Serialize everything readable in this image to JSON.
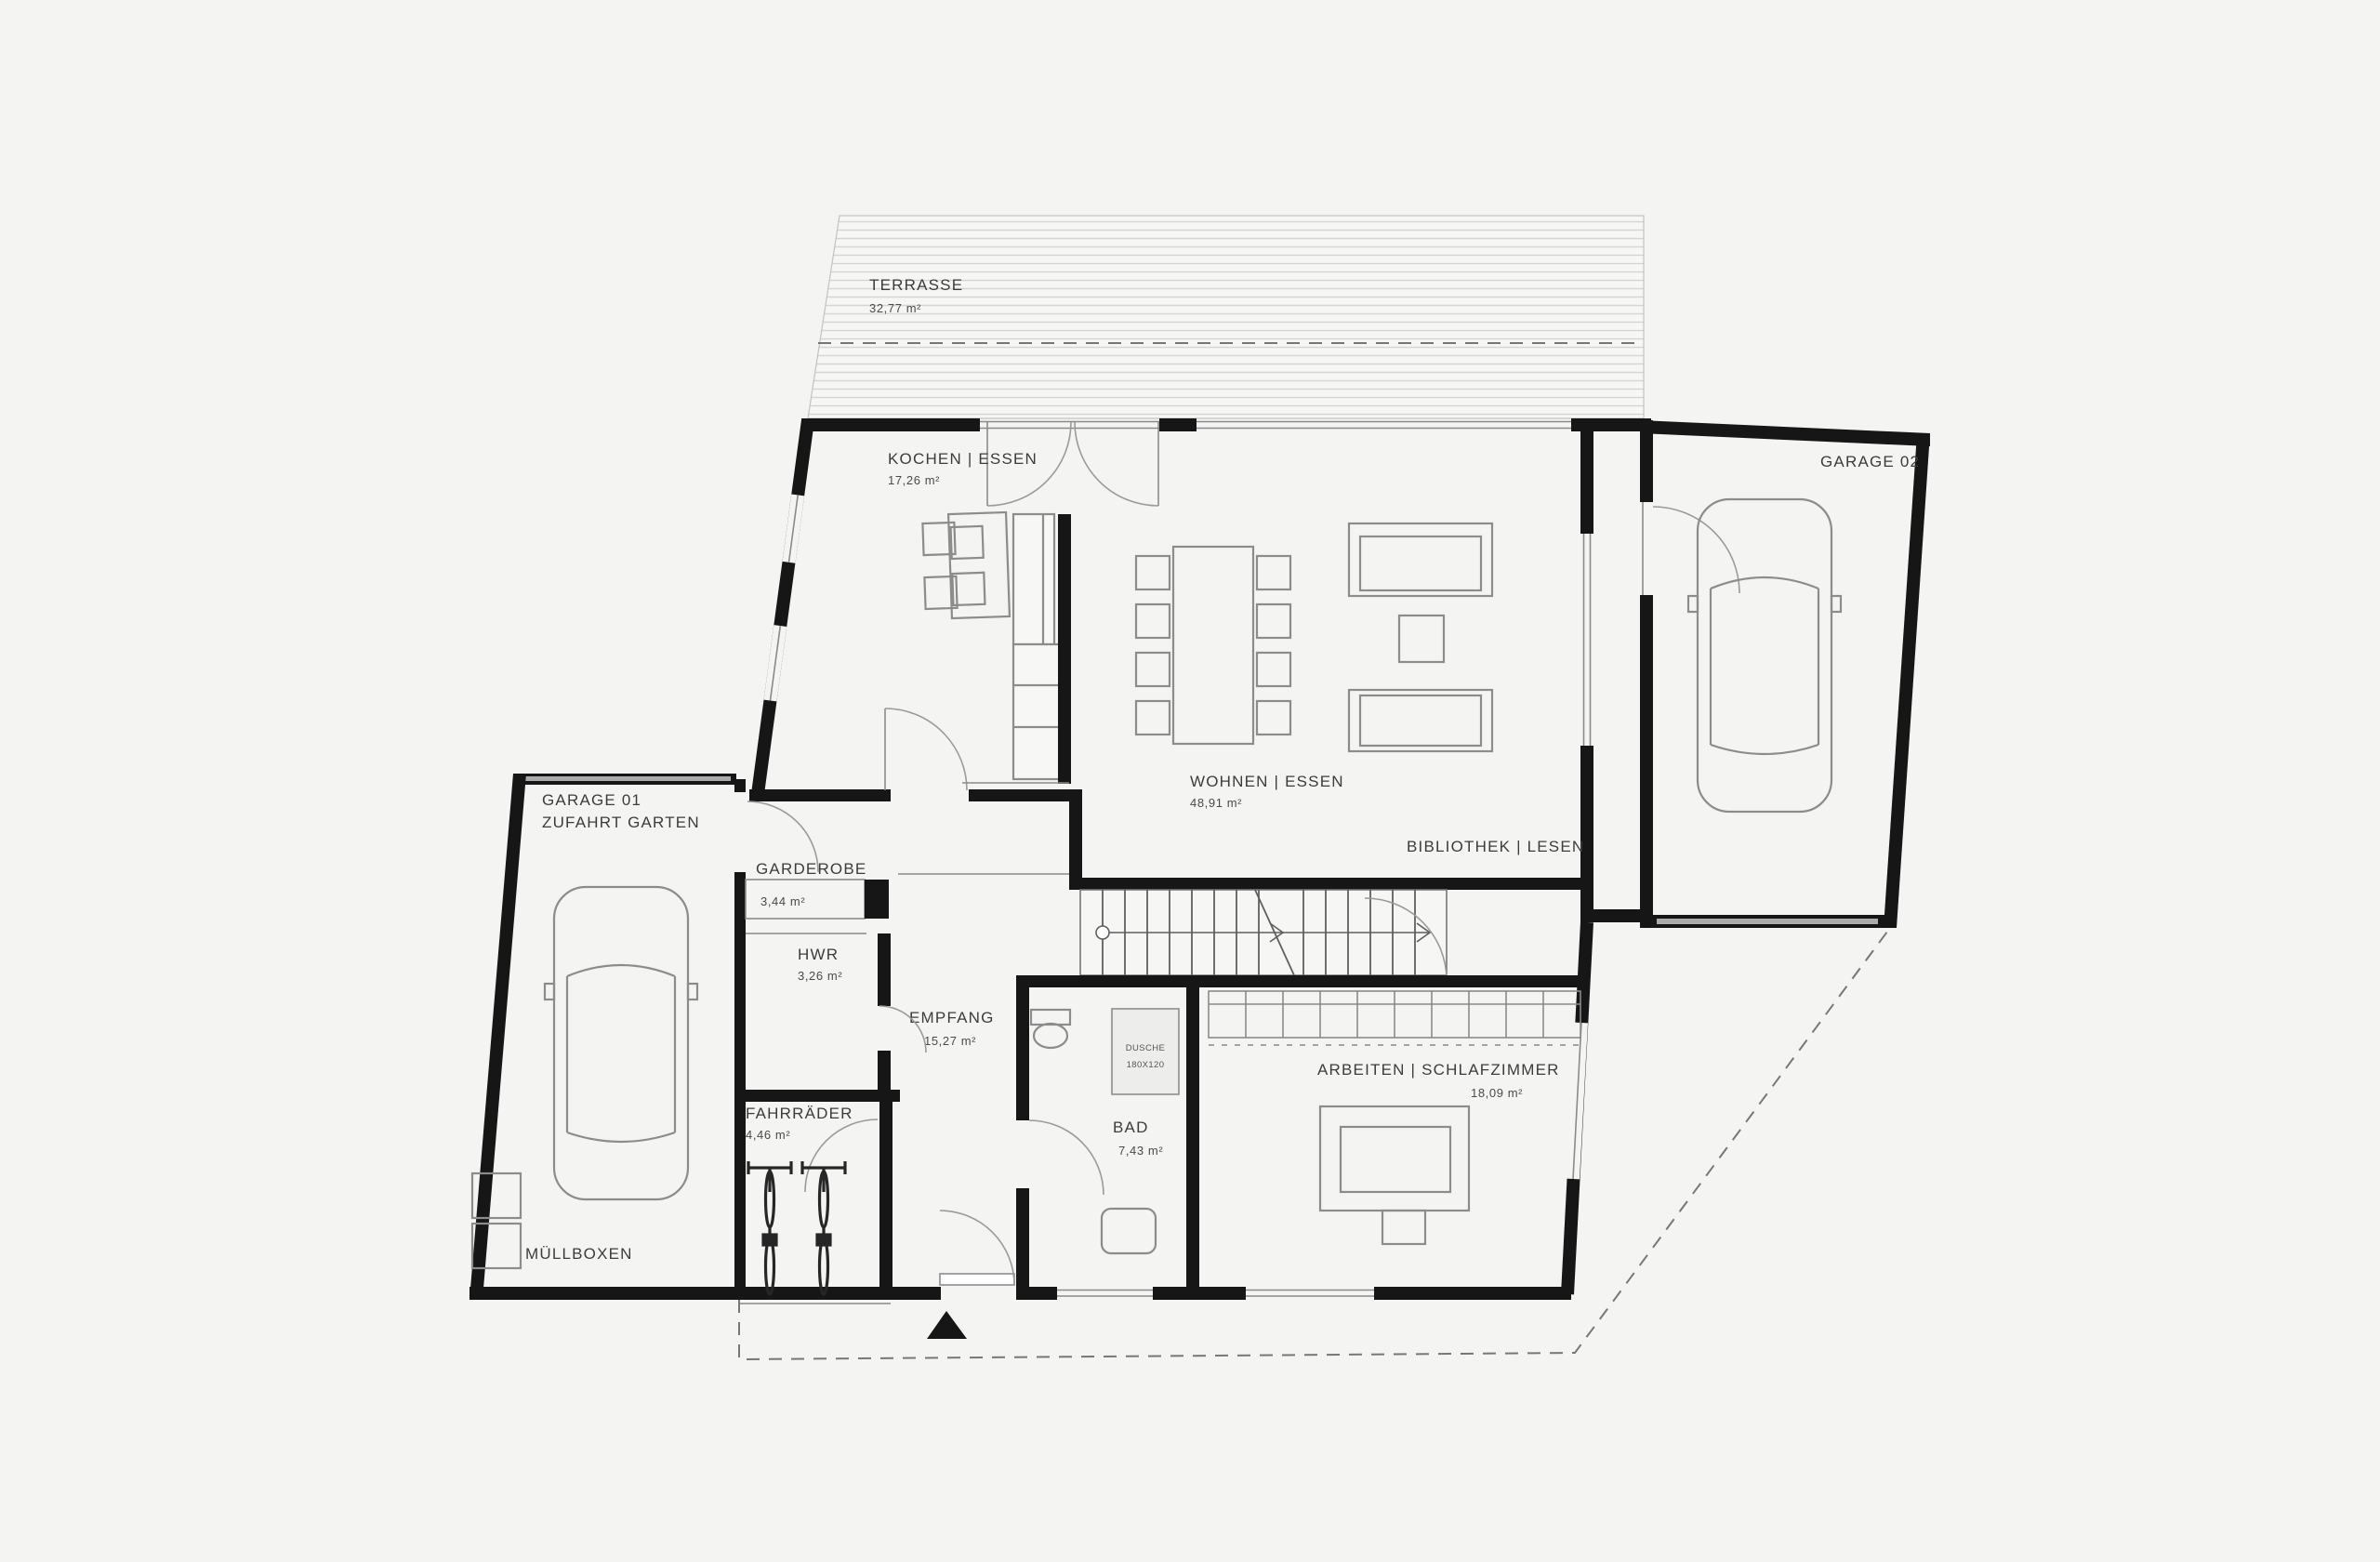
{
  "colors": {
    "background": "#f4f4f3",
    "wall": "#161616",
    "thin_line": "#8a8a8a",
    "text": "#3c3c3c",
    "terrace_hatch": "#d4d4d4"
  },
  "rooms": {
    "terrasse": {
      "label": "TERRASSE",
      "area": "32,77 m²"
    },
    "kochen": {
      "label": "KOCHEN | ESSEN",
      "area": "17,26 m²"
    },
    "wohnen": {
      "label": "WOHNEN | ESSEN",
      "area": "48,91 m²"
    },
    "bibliothek": {
      "label": "BIBLIOTHEK | LESEN"
    },
    "garage02": {
      "label": "GARAGE 02"
    },
    "garage01": {
      "label": "GARAGE 01",
      "sublabel": "ZUFAHRT GARTEN"
    },
    "garderobe": {
      "label": "GARDEROBE",
      "area": "3,44 m²"
    },
    "hwr": {
      "label": "HWR",
      "area": "3,26 m²"
    },
    "empfang": {
      "label": "EMPFANG",
      "area": "15,27 m²"
    },
    "arbeiten": {
      "label": "ARBEITEN | SCHLAFZIMMER",
      "area": "18,09 m²"
    },
    "bad": {
      "label": "BAD",
      "area": "7,43 m²"
    },
    "fahrraeder": {
      "label": "FAHRRÄDER",
      "area": "4,46 m²"
    },
    "muellboxen": {
      "label": "MÜLLBOXEN"
    },
    "dusche": {
      "label": "DUSCHE",
      "dim": "180X120"
    }
  }
}
